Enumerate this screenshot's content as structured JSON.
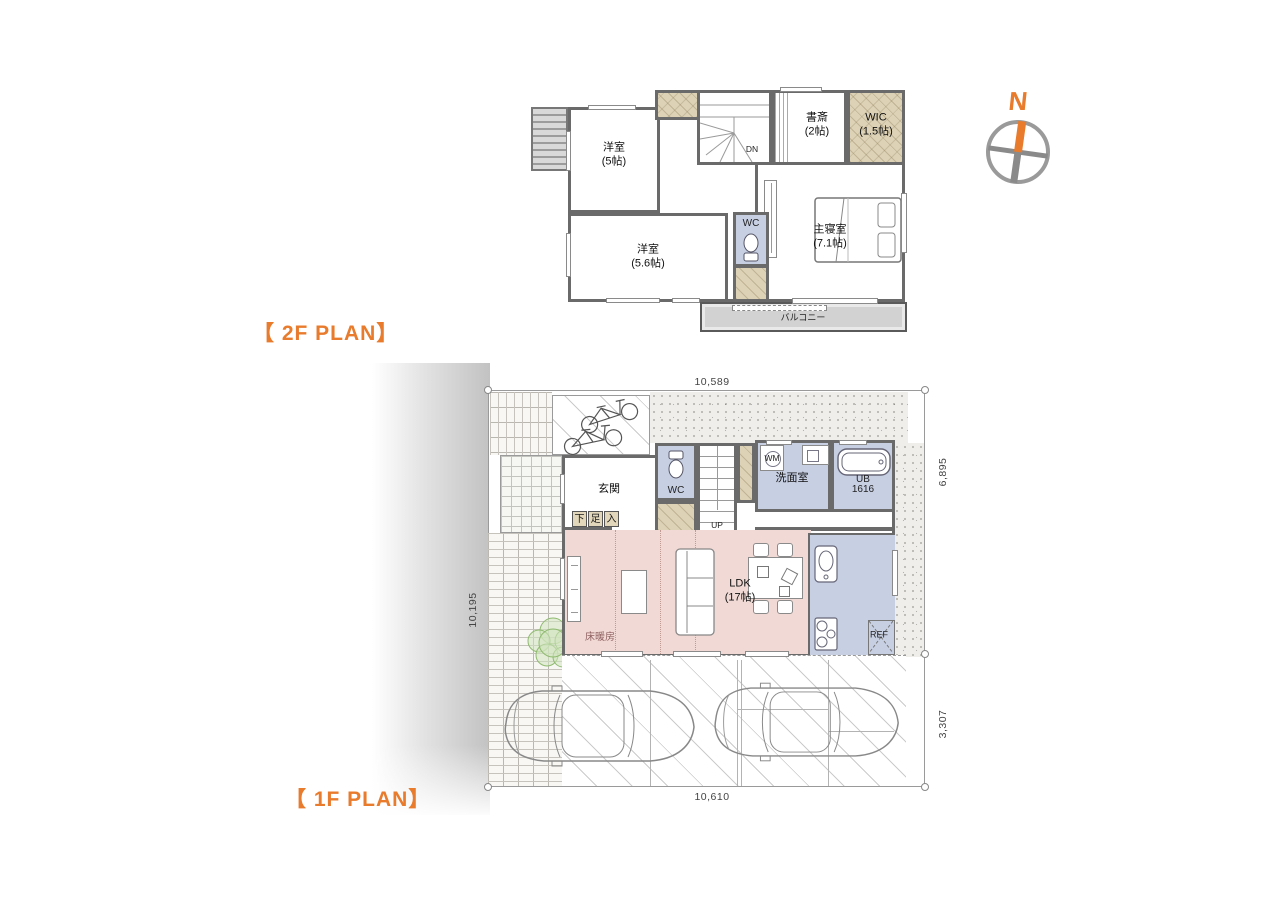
{
  "colors": {
    "accent": "#e87b2c",
    "wall": "#6a6a6a",
    "room_blue": "#c7cfe3",
    "ldk_pink": "#f1dad5",
    "closet_beige": "#ddd2b6",
    "floor_heating_text": "#8f6161"
  },
  "titles": {
    "f2": "【 2F PLAN】",
    "f1": "【 1F PLAN】"
  },
  "compass": {
    "north": "N"
  },
  "f2": {
    "yo5": {
      "name": "洋室",
      "size": "(5帖)"
    },
    "yo56": {
      "name": "洋室",
      "size": "(5.6帖)"
    },
    "shosai": {
      "name": "書斎",
      "size": "(2帖)"
    },
    "wic": {
      "name": "WIC",
      "size": "(1.5帖)"
    },
    "master": {
      "name": "主寝室",
      "size": "(7.1帖)"
    },
    "wc": "WC",
    "dn": "DN",
    "balcony": "バルコニー"
  },
  "f1": {
    "genkan": "玄関",
    "shoes": [
      "下",
      "足",
      "入"
    ],
    "wc": "WC",
    "up": "UP",
    "wm": "WM",
    "senmen": "洗面室",
    "ub": {
      "name": "UB",
      "size": "1616"
    },
    "ldk": {
      "name": "LDK",
      "size": "(17帖)"
    },
    "floor_heating": "床暖房",
    "ref": "REF",
    "dims": {
      "top": "10,589",
      "bottom": "10,610",
      "left": "10,195",
      "right_upper": "6,895",
      "right_lower": "3,307"
    }
  }
}
